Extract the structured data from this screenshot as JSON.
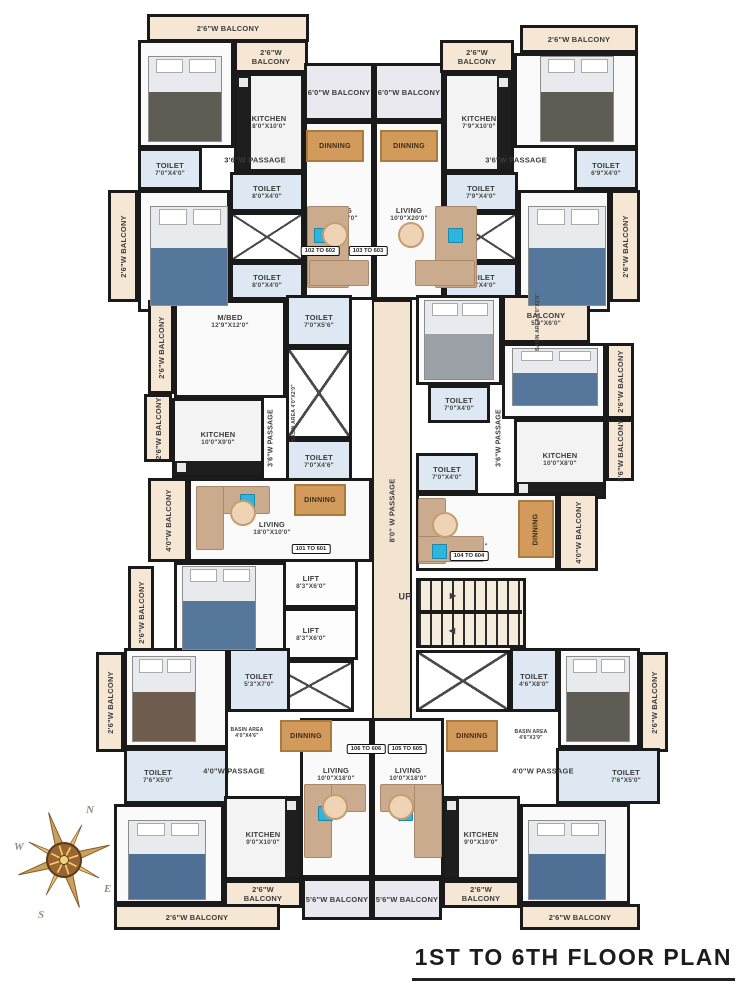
{
  "title": {
    "text": "1ST TO 6TH FLOOR PLAN"
  },
  "compass": {
    "n": "N",
    "e": "E",
    "s": "S",
    "w": "W"
  },
  "colors": {
    "wall": "#1a1a1a",
    "balcony": "#f6e7d5",
    "balcony_wide": "#ebe9f0",
    "toilet": "#dde8f2",
    "passage": "#f3e4d2",
    "accent_blue": "#2eb5dd",
    "wood": "#d29a5b",
    "sofa": "#cbab8e"
  },
  "rooms": [
    {
      "id": "balcony-102-top",
      "type": "balcony",
      "x": 147,
      "y": 14,
      "w": 162,
      "h": 28,
      "label": "2'6\"W BALCONY"
    },
    {
      "id": "mbed-102",
      "type": "room",
      "x": 138,
      "y": 40,
      "w": 96,
      "h": 108,
      "label": "M/BED",
      "dims": "10'6\"X13'0\"",
      "ldy": 18
    },
    {
      "id": "balcony-102-small",
      "type": "balcony",
      "x": 234,
      "y": 40,
      "w": 74,
      "h": 33,
      "label": "2'6\"W\nBALCONY"
    },
    {
      "id": "kitchen-102",
      "type": "kitchen",
      "x": 234,
      "y": 73,
      "w": 70,
      "h": 99,
      "label": "KITCHEN",
      "dims": "8'0\"X10'0\"",
      "counter": "left"
    },
    {
      "id": "balcony-6-left",
      "type": "balcony6",
      "x": 304,
      "y": 63,
      "w": 70,
      "h": 58,
      "label": "6'0\"W BALCONY"
    },
    {
      "id": "toilet-102-a",
      "type": "toilet",
      "x": 138,
      "y": 148,
      "w": 64,
      "h": 42,
      "label": "TOILET",
      "dims": "7'0\"X4'0\""
    },
    {
      "id": "toilet-102-b",
      "type": "toilet",
      "x": 230,
      "y": 172,
      "w": 74,
      "h": 40,
      "label": "TOILET",
      "dims": "8'0\"X4'0\""
    },
    {
      "id": "duct-102",
      "type": "duct",
      "x": 230,
      "y": 212,
      "w": 74,
      "h": 50
    },
    {
      "id": "toilet-102-c",
      "type": "toilet",
      "x": 230,
      "y": 262,
      "w": 74,
      "h": 38,
      "label": "TOILET",
      "dims": "8'0\"X4'0\""
    },
    {
      "id": "mbed-102-b",
      "type": "room",
      "x": 138,
      "y": 190,
      "w": 92,
      "h": 122,
      "label": "M/BED",
      "dims": "10'6\"X12'6\"",
      "ldy": -34
    },
    {
      "id": "balcony-left-1",
      "type": "balcony",
      "x": 108,
      "y": 190,
      "w": 30,
      "h": 112,
      "label": "2'6\"W BALCONY",
      "rot": true
    },
    {
      "id": "living-102",
      "type": "room",
      "x": 304,
      "y": 121,
      "w": 70,
      "h": 179,
      "label": "LIVING",
      "dims": "10'0\"X20'0\"",
      "ldy": 4
    },
    {
      "id": "balcony-6-right",
      "type": "balcony6",
      "x": 374,
      "y": 63,
      "w": 70,
      "h": 58,
      "label": "6'0\"W BALCONY"
    },
    {
      "id": "living-103",
      "type": "room",
      "x": 374,
      "y": 121,
      "w": 70,
      "h": 179,
      "label": "LIVING",
      "dims": "10'0\"X20'0\"",
      "ldy": 4
    },
    {
      "id": "kitchen-103",
      "type": "kitchen",
      "x": 444,
      "y": 73,
      "w": 70,
      "h": 99,
      "label": "KITCHEN",
      "dims": "7'9\"X10'0\"",
      "counter": "right"
    },
    {
      "id": "balcony-103-small",
      "type": "balcony",
      "x": 440,
      "y": 40,
      "w": 74,
      "h": 33,
      "label": "2'6\"W\nBALCONY"
    },
    {
      "id": "balcony-103-top",
      "type": "balcony",
      "x": 520,
      "y": 25,
      "w": 118,
      "h": 28,
      "label": "2'6\"W BALCONY"
    },
    {
      "id": "mbed-103",
      "type": "room",
      "x": 514,
      "y": 53,
      "w": 124,
      "h": 95,
      "label": "M/BED",
      "dims": "10'0\"X11'0\"",
      "ldy": 22
    },
    {
      "id": "toilet-103-a",
      "type": "toilet",
      "x": 574,
      "y": 148,
      "w": 64,
      "h": 42,
      "label": "TOILET",
      "dims": "6'9\"X4'0\""
    },
    {
      "id": "toilet-103-b",
      "type": "toilet",
      "x": 444,
      "y": 172,
      "w": 74,
      "h": 40,
      "label": "TOILET",
      "dims": "7'9\"X4'0\""
    },
    {
      "id": "duct-103",
      "type": "duct",
      "x": 444,
      "y": 212,
      "w": 74,
      "h": 50
    },
    {
      "id": "toilet-103-c",
      "type": "toilet",
      "x": 444,
      "y": 262,
      "w": 74,
      "h": 38,
      "label": "TOILET",
      "dims": "7'9\"X4'0\""
    },
    {
      "id": "mbed-103-b",
      "type": "room",
      "x": 518,
      "y": 190,
      "w": 92,
      "h": 122,
      "label": "M/BED",
      "dims": "10'6\"X12'6\"",
      "ldy": -34
    },
    {
      "id": "balcony-right-1",
      "type": "balcony",
      "x": 610,
      "y": 190,
      "w": 30,
      "h": 112,
      "label": "2'6\"W BALCONY",
      "rot": true
    },
    {
      "id": "toilet-center-top",
      "type": "toilet",
      "x": 286,
      "y": 295,
      "w": 66,
      "h": 52,
      "label": "TOILET",
      "dims": "7'0\"X5'6\""
    },
    {
      "id": "duct-center",
      "type": "duct",
      "x": 286,
      "y": 347,
      "w": 66,
      "h": 92
    },
    {
      "id": "toilet-center",
      "type": "toilet",
      "x": 286,
      "y": 439,
      "w": 66,
      "h": 44,
      "label": "TOILET",
      "dims": "7'0\"X4'6\""
    },
    {
      "id": "passage-main",
      "type": "passage",
      "x": 372,
      "y": 300,
      "w": 40,
      "h": 420,
      "label": "8'0\" W PASSAGE",
      "rot": true
    },
    {
      "id": "lift-1",
      "type": "lift",
      "x": 264,
      "y": 556,
      "w": 94,
      "h": 52,
      "label": "LIFT",
      "dims": "8'3\"X6'0\""
    },
    {
      "id": "lift-2",
      "type": "lift",
      "x": 264,
      "y": 608,
      "w": 94,
      "h": 52,
      "label": "LIFT",
      "dims": "8'3\"X6'0\""
    },
    {
      "id": "duct-lifts",
      "type": "duct",
      "x": 264,
      "y": 660,
      "w": 90,
      "h": 52
    },
    {
      "id": "stair",
      "type": "stair",
      "x": 416,
      "y": 578,
      "w": 110,
      "h": 70
    },
    {
      "id": "duct-stair",
      "type": "duct",
      "x": 416,
      "y": 650,
      "w": 94,
      "h": 62
    },
    {
      "id": "balcony-left-2",
      "type": "balcony",
      "x": 148,
      "y": 300,
      "w": 26,
      "h": 94,
      "label": "2'6\"W BALCONY",
      "rot": true
    },
    {
      "id": "mbed-101",
      "type": "room",
      "x": 174,
      "y": 300,
      "w": 112,
      "h": 98,
      "label": "M/BED",
      "dims": "12'9\"X12'0\"",
      "ldy": -28
    },
    {
      "id": "balcony-left-3",
      "type": "balcony",
      "x": 144,
      "y": 394,
      "w": 28,
      "h": 68,
      "label": "2'6\"W BALCONY",
      "rot": true
    },
    {
      "id": "kitchen-101",
      "type": "kitchen",
      "x": 172,
      "y": 398,
      "w": 92,
      "h": 80,
      "label": "KITCHEN",
      "dims": "10'0\"X9'0\"",
      "counter": "bottom"
    },
    {
      "id": "balcony-left-4",
      "type": "balcony",
      "x": 148,
      "y": 478,
      "w": 40,
      "h": 84,
      "label": "4'0\"W BALCONY",
      "rot": true
    },
    {
      "id": "living-101",
      "type": "room",
      "x": 188,
      "y": 478,
      "w": 184,
      "h": 84,
      "label": "LIVING",
      "dims": "18'0\"X10'0\"",
      "ldx": -8,
      "ldy": 8
    },
    {
      "id": "bed-101",
      "type": "room",
      "x": 174,
      "y": 562,
      "w": 112,
      "h": 94,
      "label": "BED",
      "dims": "12'0\"X10'0\"",
      "ldy": -24
    },
    {
      "id": "balcony-left-5",
      "type": "balcony",
      "x": 128,
      "y": 566,
      "w": 26,
      "h": 92,
      "label": "2'6\"W BALCONY",
      "rot": true
    },
    {
      "id": "mbed-104",
      "type": "room",
      "x": 416,
      "y": 295,
      "w": 86,
      "h": 90,
      "label": "M/BED",
      "dims": "11'0\"X10'0\"",
      "ldy": 14
    },
    {
      "id": "balcony-104",
      "type": "balcony",
      "x": 502,
      "y": 295,
      "w": 88,
      "h": 48,
      "label": "BALCONY",
      "dims": "5'3\"X6'0\""
    },
    {
      "id": "bed-104",
      "type": "room",
      "x": 502,
      "y": 343,
      "w": 104,
      "h": 76,
      "label": "BED",
      "dims": "11'0\"X9'0\"",
      "ldy": 18,
      "ldx": 14
    },
    {
      "id": "balcony-right-2",
      "type": "balcony",
      "x": 606,
      "y": 343,
      "w": 28,
      "h": 76,
      "label": "2'6\"W BALCONY",
      "rot": true
    },
    {
      "id": "toilet-104-a",
      "type": "toilet",
      "x": 428,
      "y": 385,
      "w": 62,
      "h": 38,
      "label": "TOILET",
      "dims": "7'0\"X4'0\""
    },
    {
      "id": "kitchen-104",
      "type": "kitchen",
      "x": 514,
      "y": 419,
      "w": 92,
      "h": 80,
      "label": "KITCHEN",
      "dims": "10'0\"X8'0\"",
      "counter": "bottom"
    },
    {
      "id": "balcony-right-3",
      "type": "balcony",
      "x": 606,
      "y": 419,
      "w": 28,
      "h": 62,
      "label": "2'6\"W\nBALCONY",
      "rot": true
    },
    {
      "id": "toilet-104-b",
      "type": "toilet",
      "x": 416,
      "y": 453,
      "w": 62,
      "h": 40,
      "label": "TOILET",
      "dims": "7'0\"X4'0\""
    },
    {
      "id": "living-104",
      "type": "room",
      "x": 416,
      "y": 493,
      "w": 142,
      "h": 78,
      "label": "LIVING",
      "dims": "16'0\"X10'0\"",
      "ldx": -18,
      "ldy": 10
    },
    {
      "id": "balcony-right-4",
      "type": "balcony",
      "x": 558,
      "y": 493,
      "w": 40,
      "h": 78,
      "label": "4'0\"W BALCONY",
      "rot": true
    },
    {
      "id": "balcony-left-6",
      "type": "balcony",
      "x": 96,
      "y": 652,
      "w": 28,
      "h": 100,
      "label": "2'6\"W BALCONY",
      "rot": true
    },
    {
      "id": "bed-106",
      "type": "room",
      "x": 124,
      "y": 648,
      "w": 104,
      "h": 100,
      "label": "BED",
      "dims": "12'0\"X11'0\"",
      "ldy": -24
    },
    {
      "id": "toilet-106-a",
      "type": "toilet",
      "x": 228,
      "y": 648,
      "w": 62,
      "h": 64,
      "label": "TOILET",
      "dims": "5'3\"X7'0\""
    },
    {
      "id": "toilet-106-b",
      "type": "toilet",
      "x": 124,
      "y": 748,
      "w": 104,
      "h": 56,
      "label": "TOILET",
      "dims": "7'6\"X5'0\"",
      "ldx": -18
    },
    {
      "id": "living-106",
      "type": "room",
      "x": 300,
      "y": 718,
      "w": 72,
      "h": 160,
      "label": "LIVING",
      "dims": "10'0\"X18'0\"",
      "ldy": -24
    },
    {
      "id": "mbed-106",
      "type": "room",
      "x": 114,
      "y": 804,
      "w": 110,
      "h": 100,
      "label": "M/BED",
      "dims": "11'0\"X13'0\"",
      "ldy": -26
    },
    {
      "id": "kitchen-106",
      "type": "kitchen",
      "x": 224,
      "y": 796,
      "w": 78,
      "h": 84,
      "label": "KITCHEN",
      "dims": "9'0\"X10'0\"",
      "counter": "right"
    },
    {
      "id": "balcony-106-small",
      "type": "balcony",
      "x": 224,
      "y": 880,
      "w": 78,
      "h": 28,
      "label": "2'6\"W\nBALCONY"
    },
    {
      "id": "balcony-106-56",
      "type": "balcony6",
      "x": 302,
      "y": 878,
      "w": 70,
      "h": 42,
      "label": "5'6\"W BALCONY"
    },
    {
      "id": "balcony-106-bottom",
      "type": "balcony",
      "x": 114,
      "y": 904,
      "w": 166,
      "h": 26,
      "label": "2'6\"W BALCONY"
    },
    {
      "id": "toilet-105-a",
      "type": "toilet",
      "x": 510,
      "y": 648,
      "w": 48,
      "h": 64,
      "label": "TOILET",
      "dims": "4'6\"X8'0\""
    },
    {
      "id": "bed-105",
      "type": "room",
      "x": 558,
      "y": 648,
      "w": 82,
      "h": 100,
      "label": "BED",
      "dims": "11'0\"X11'0\"",
      "ldy": -24
    },
    {
      "id": "balcony-right-5",
      "type": "balcony",
      "x": 640,
      "y": 652,
      "w": 28,
      "h": 100,
      "label": "2'6\"W BALCONY",
      "rot": true
    },
    {
      "id": "toilet-105-b",
      "type": "toilet",
      "x": 556,
      "y": 748,
      "w": 104,
      "h": 56,
      "label": "TOILET",
      "dims": "7'6\"X5'0\"",
      "ldx": 18
    },
    {
      "id": "living-105",
      "type": "room",
      "x": 372,
      "y": 718,
      "w": 72,
      "h": 160,
      "label": "LIVING",
      "dims": "10'0\"X18'0\"",
      "ldy": -24
    },
    {
      "id": "kitchen-105",
      "type": "kitchen",
      "x": 442,
      "y": 796,
      "w": 78,
      "h": 84,
      "label": "KITCHEN",
      "dims": "9'0\"X10'0\"",
      "counter": "left"
    },
    {
      "id": "mbed-105",
      "type": "room",
      "x": 520,
      "y": 804,
      "w": 110,
      "h": 100,
      "label": "M/BED",
      "dims": "11'0\"X13'0\"",
      "ldy": -26
    },
    {
      "id": "balcony-105-small",
      "type": "balcony",
      "x": 442,
      "y": 880,
      "w": 78,
      "h": 28,
      "label": "2'6\"W\nBALCONY"
    },
    {
      "id": "balcony-105-56",
      "type": "balcony6",
      "x": 372,
      "y": 878,
      "w": 70,
      "h": 42,
      "label": "5'6\"W BALCONY"
    },
    {
      "id": "balcony-105-bottom",
      "type": "balcony",
      "x": 520,
      "y": 904,
      "w": 120,
      "h": 26,
      "label": "2'6\"W BALCONY"
    }
  ],
  "unit_boxes": [
    {
      "t": "102 TO 602",
      "x": 320,
      "y": 251
    },
    {
      "t": "103 TO 603",
      "x": 368,
      "y": 251
    },
    {
      "t": "101 TO 601",
      "x": 311,
      "y": 549
    },
    {
      "t": "104 TO 604",
      "x": 469,
      "y": 556
    },
    {
      "t": "106 TO 606",
      "x": 366,
      "y": 749
    },
    {
      "t": "105 TO 605",
      "x": 407,
      "y": 749
    }
  ],
  "labels": [
    {
      "t": "3'6\"W PASSAGE",
      "x": 255,
      "y": 160,
      "s": 7.5
    },
    {
      "t": "3'6\"W PASSAGE",
      "x": 516,
      "y": 160,
      "s": 7.5
    },
    {
      "t": "3'6\"W PASSAGE",
      "x": 272,
      "y": 438,
      "s": 7,
      "rot": true
    },
    {
      "t": "3'6\"W PASSAGE",
      "x": 500,
      "y": 438,
      "s": 7,
      "rot": true
    },
    {
      "t": "BASIN AREA\n4'0\"X2'0\"",
      "x": 294,
      "y": 413,
      "s": 5,
      "rot": true
    },
    {
      "t": "BASIN AREA\n4'0\"X2'0\"",
      "x": 538,
      "y": 322,
      "s": 5,
      "rot": true
    },
    {
      "t": "BASIN AREA\n4'0\"X4'6\"",
      "x": 247,
      "y": 733,
      "s": 5
    },
    {
      "t": "BASIN AREA\n4'6\"X3'9\"",
      "x": 531,
      "y": 735,
      "s": 5
    },
    {
      "t": "4'0\"W PASSAGE",
      "x": 234,
      "y": 771,
      "s": 7.5
    },
    {
      "t": "4'0\"W PASSAGE",
      "x": 543,
      "y": 771,
      "s": 7.5
    },
    {
      "t": "UP",
      "x": 405,
      "y": 597,
      "s": 9
    },
    {
      "t": "▶",
      "x": 453,
      "y": 596,
      "s": 8,
      "name": "stair-up-arrow-icon"
    },
    {
      "t": "◀",
      "x": 452,
      "y": 631,
      "s": 8,
      "name": "stair-down-arrow-icon"
    }
  ],
  "furniture": [
    {
      "type": "bed",
      "x": 148,
      "y": 56,
      "w": 74,
      "h": 86,
      "c": "#5f5b55"
    },
    {
      "type": "bed",
      "x": 150,
      "y": 206,
      "w": 78,
      "h": 100,
      "c": "#56779c"
    },
    {
      "type": "bed",
      "x": 540,
      "y": 56,
      "w": 74,
      "h": 86,
      "c": "#5f5b55"
    },
    {
      "type": "bed",
      "x": 528,
      "y": 206,
      "w": 78,
      "h": 100,
      "c": "#56779c"
    },
    {
      "type": "bed",
      "x": 424,
      "y": 300,
      "w": 70,
      "h": 80,
      "c": "#9aa0a6"
    },
    {
      "type": "bed",
      "x": 512,
      "y": 348,
      "w": 86,
      "h": 58,
      "c": "#56779c"
    },
    {
      "type": "bed",
      "x": 182,
      "y": 566,
      "w": 74,
      "h": 84,
      "c": "#56779c"
    },
    {
      "type": "bed",
      "x": 132,
      "y": 656,
      "w": 64,
      "h": 86,
      "c": "#6e5c4e"
    },
    {
      "type": "bed",
      "x": 566,
      "y": 656,
      "w": 64,
      "h": 86,
      "c": "#5f5b55"
    },
    {
      "type": "bed",
      "x": 128,
      "y": 820,
      "w": 78,
      "h": 80,
      "c": "#4f6f94"
    },
    {
      "type": "bed",
      "x": 528,
      "y": 820,
      "w": 78,
      "h": 80,
      "c": "#4f6f94"
    },
    {
      "type": "sofa",
      "x": 307,
      "y": 206,
      "w": 42,
      "h": 82
    },
    {
      "type": "sofa",
      "x": 309,
      "y": 260,
      "w": 60,
      "h": 26
    },
    {
      "type": "sofa",
      "x": 435,
      "y": 206,
      "w": 42,
      "h": 82
    },
    {
      "type": "sofa",
      "x": 415,
      "y": 260,
      "w": 60,
      "h": 26
    },
    {
      "type": "sofa",
      "x": 196,
      "y": 486,
      "w": 74,
      "h": 28
    },
    {
      "type": "sofa",
      "x": 196,
      "y": 486,
      "w": 28,
      "h": 64
    },
    {
      "type": "sofa",
      "x": 418,
      "y": 498,
      "w": 28,
      "h": 66
    },
    {
      "type": "sofa",
      "x": 418,
      "y": 536,
      "w": 66,
      "h": 26
    },
    {
      "type": "sofa",
      "x": 304,
      "y": 784,
      "w": 62,
      "h": 28
    },
    {
      "type": "sofa",
      "x": 304,
      "y": 784,
      "w": 28,
      "h": 74
    },
    {
      "type": "sofa",
      "x": 380,
      "y": 784,
      "w": 62,
      "h": 28
    },
    {
      "type": "sofa",
      "x": 414,
      "y": 784,
      "w": 28,
      "h": 74
    },
    {
      "type": "accent",
      "x": 314,
      "y": 228,
      "w": 15,
      "h": 15
    },
    {
      "type": "accent",
      "x": 448,
      "y": 228,
      "w": 15,
      "h": 15
    },
    {
      "type": "accent",
      "x": 240,
      "y": 494,
      "w": 15,
      "h": 15
    },
    {
      "type": "accent",
      "x": 432,
      "y": 544,
      "w": 15,
      "h": 15
    },
    {
      "type": "accent",
      "x": 318,
      "y": 806,
      "w": 15,
      "h": 15
    },
    {
      "type": "accent",
      "x": 398,
      "y": 806,
      "w": 15,
      "h": 15
    },
    {
      "type": "round",
      "x": 322,
      "y": 222,
      "w": 26,
      "h": 26
    },
    {
      "type": "round",
      "x": 398,
      "y": 222,
      "w": 26,
      "h": 26
    },
    {
      "type": "round",
      "x": 230,
      "y": 500,
      "w": 26,
      "h": 26
    },
    {
      "type": "round",
      "x": 432,
      "y": 512,
      "w": 26,
      "h": 26
    },
    {
      "type": "round",
      "x": 322,
      "y": 794,
      "w": 26,
      "h": 26
    },
    {
      "type": "round",
      "x": 388,
      "y": 794,
      "w": 26,
      "h": 26
    },
    {
      "type": "table",
      "x": 306,
      "y": 130,
      "w": 58,
      "h": 32,
      "t": "DINNING"
    },
    {
      "type": "table",
      "x": 380,
      "y": 130,
      "w": 58,
      "h": 32,
      "t": "DINNING"
    },
    {
      "type": "table",
      "x": 294,
      "y": 484,
      "w": 52,
      "h": 32,
      "t": "DINNING"
    },
    {
      "type": "table",
      "x": 518,
      "y": 500,
      "w": 36,
      "h": 58,
      "t": "DINNING",
      "rot": true
    },
    {
      "type": "table",
      "x": 280,
      "y": 720,
      "w": 52,
      "h": 32,
      "t": "DINNING"
    },
    {
      "type": "table",
      "x": 446,
      "y": 720,
      "w": 52,
      "h": 32,
      "t": "DINNING"
    },
    {
      "type": "wallbar",
      "x": 418,
      "y": 610,
      "w": 104,
      "h": 4
    }
  ]
}
